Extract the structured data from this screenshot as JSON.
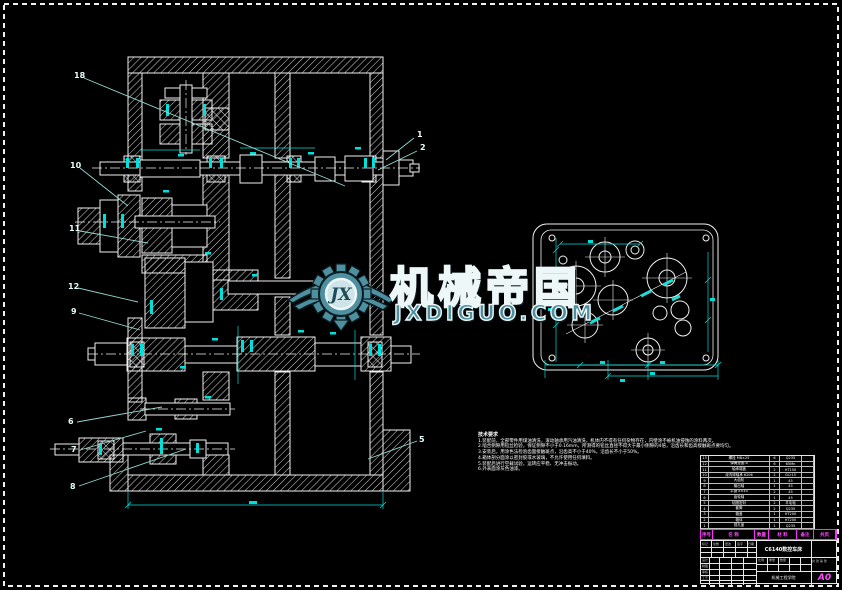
{
  "colors": {
    "background": "#000000",
    "line": "#f0f0f0",
    "dimension_cyan": "#00e0da",
    "leader_cyan": "#93d6cf",
    "magenta": "#ff2bff",
    "watermark_teal": "#4e8fa0",
    "watermark_outline": "#eef7f7"
  },
  "watermark": {
    "brand": "机械帝国",
    "domain": "JXDIGUO.COM",
    "monogram": "JX"
  },
  "notes": {
    "title": "技术要求",
    "lines": [
      "1.装配前，全部零件用煤油清洗，滚动轴承用汽油清洗，机体内不得有任何杂物存在，内壁涂不被机油侵蚀的涂料两次。",
      "2.啮合侧隙用铅丝检验，保证侧隙不小于0.16mm，所测得的铅丝直径不得大于最小侧隙的4倍，沿齿长和齿高接触斑点要均匀。",
      "3.安装后，用涂色法检验齿面接触斑点，沿齿高不小于40%，沿齿长不小于50%。",
      "4.箱体剖分面涂以密封胶或水玻璃，不允许使用任何填料。",
      "5.装配后进行空载试验，运转应平稳、无冲击振动。",
      "6.外表面涂灰色油漆。"
    ]
  },
  "balloons": [
    {
      "label": "18"
    },
    {
      "label": "1"
    },
    {
      "label": "2"
    },
    {
      "label": "10"
    },
    {
      "label": "11"
    },
    {
      "label": "12"
    },
    {
      "label": "9"
    },
    {
      "label": "6"
    },
    {
      "label": "7"
    },
    {
      "label": "8"
    },
    {
      "label": "5"
    }
  ],
  "bom": {
    "headers": [
      "序号",
      "名 称",
      "数量",
      "材 料",
      "备注",
      "共页"
    ],
    "rows": [
      [
        "13",
        "螺栓 M8×25",
        "6",
        "Q235",
        ""
      ],
      [
        "12",
        "弹簧垫圈 8",
        "6",
        "65Mn",
        ""
      ],
      [
        "11",
        "轴承端盖",
        "2",
        "HT150",
        ""
      ],
      [
        "10",
        "深沟球轴承 6206",
        "2",
        "GCr15",
        ""
      ],
      [
        "9",
        "大齿轮",
        "1",
        "45",
        ""
      ],
      [
        "8",
        "输出轴",
        "1",
        "45",
        ""
      ],
      [
        "7",
        "平键 8×40",
        "2",
        "45",
        ""
      ],
      [
        "6",
        "齿轮轴",
        "1",
        "45",
        ""
      ],
      [
        "5",
        "毡圈密封",
        "2",
        "羊毛毡",
        ""
      ],
      [
        "4",
        "套筒",
        "2",
        "Q235",
        ""
      ],
      [
        "3",
        "箱盖",
        "1",
        "HT200",
        ""
      ],
      [
        "2",
        "箱体",
        "1",
        "HT200",
        ""
      ],
      [
        "1",
        "视孔盖",
        "1",
        "Q235",
        ""
      ]
    ]
  },
  "title_block": {
    "title": "C6140数控车床",
    "org": "机械工程学院",
    "size": "A0",
    "labels": {
      "mark": "标记",
      "count": "处数",
      "change": "更改",
      "sign": "签字",
      "date": "日期",
      "design": "设计",
      "draft": "制图",
      "check": "审核",
      "process": "工艺",
      "scale": "比例",
      "weight": "重量",
      "qty": "数量",
      "sheets": "共 张 第 张"
    }
  }
}
